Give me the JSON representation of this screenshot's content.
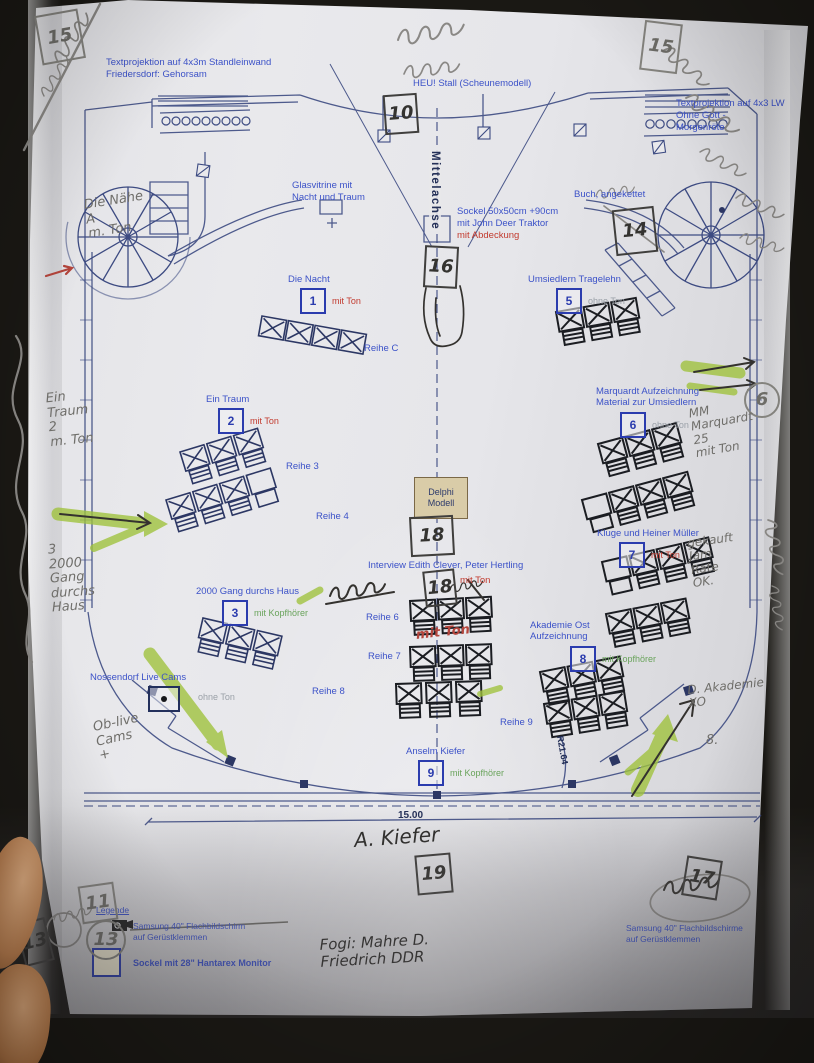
{
  "labels": {
    "textprojektion_left": "Textprojektion auf 4x3m Standleinwand\nFriedersdorf: Gehorsam",
    "heustall": "HEU! Stall (Scheunemodell)",
    "textprojektion_right": "Textprojektion auf 4x3 LW\nOhne Gott -\nMorgenröte",
    "glasvitrine": "Glasvitrine mit\nNacht und Traum",
    "mittelachse": "Mittelachse",
    "sockel": "Sockel 50x50cm  +90cm\nmit John Deer Traktor",
    "sockel_note": "mit Abdeckung",
    "buch": "Buch, angekettet",
    "delphi": "Delphi\nModell",
    "interview": "Interview Edith Clever, Peter Hertling",
    "interview_note": "mit Ton"
  },
  "stations": [
    {
      "num": "1",
      "title": "Die Nacht",
      "note": "mit Ton"
    },
    {
      "num": "2",
      "title": "Ein Traum",
      "note": "mit Ton"
    },
    {
      "num": "3",
      "title": "2000 Gang durchs Haus",
      "note": "mit Kopfhörer"
    },
    {
      "num": "4",
      "title": "Nossendorf Live Cams",
      "note": "ohne Ton"
    },
    {
      "num": "5",
      "title": "Umsiedlern Tragelehn",
      "note": "ohne Ton"
    },
    {
      "num": "6",
      "title": "Marquardt Aufzeichnung\nMaterial zur Umsiedlern",
      "note": "ohne Ton"
    },
    {
      "num": "7",
      "title": "Kluge und Heiner Müller",
      "note": "mit Ton"
    },
    {
      "num": "8",
      "title": "Akademie Ost\nAufzeichnung",
      "note": "mit Kopfhörer"
    },
    {
      "num": "9",
      "title": "Anselm Kiefer",
      "note": "mit Kopfhörer"
    }
  ],
  "rows": {
    "c": "Reihe C",
    "r3": "Reihe 3",
    "r4": "Reihe 4",
    "r6": "Reihe 6",
    "r7": "Reihe 7",
    "r8": "Reihe 8",
    "r9": "Reihe 9"
  },
  "dimensions": {
    "hall_width": "15.00",
    "radius": "R21.64"
  },
  "legend": {
    "title": "Legende",
    "screen": "Samsung 40\" Flachbildschirm\nauf Gerüstklemmen",
    "sockel": "Sockel mit 28\" Hantarex Monitor",
    "screens_right": "Samsung 40\" Flachbildschirme\nauf Gerüstklemmen"
  },
  "handwritten": {
    "box_top_left": "15",
    "box_heustall": "10",
    "box_top_right": "15",
    "box_sockel": "16",
    "box_buch": "14",
    "box_delphi": "18",
    "box_interview": "18",
    "circle_marquardt": "6",
    "box_kiefer": "19",
    "box_legend": "11",
    "circle_legend": "13",
    "box_bottom_right": "17",
    "box_edge_left": "13",
    "note_naehe": "Die Nähe\nA\nm. Ton",
    "note_ein_traum": "Ein\nTraum\n2\nm. Ton",
    "note_gang": "3\n2000\nGang\ndurchs\nHaus",
    "note_cams": "Ob-live\nCams\n+",
    "note_marquardt": "MM\nMarquardt\n25\nmit Ton",
    "note_rate": "gekauft\nJam\nRate\nOK.",
    "note_akademie": "D. Akademie\nXO",
    "note_eight": "8.",
    "note_kiefer": "A. Kiefer",
    "note_bottom": "Fogi: Mahre D.\nFriedrich DDR",
    "note_mit_ton_red": "mit Ton"
  },
  "colors": {
    "print_blue": "#3c52c8",
    "print_navy": "#2c3a6b",
    "note_red": "#c23a2e",
    "note_green": "#69a35b",
    "note_gray": "#9aa0a8",
    "highlighter": "#9fc23b",
    "paper": "#e7e7ea"
  }
}
